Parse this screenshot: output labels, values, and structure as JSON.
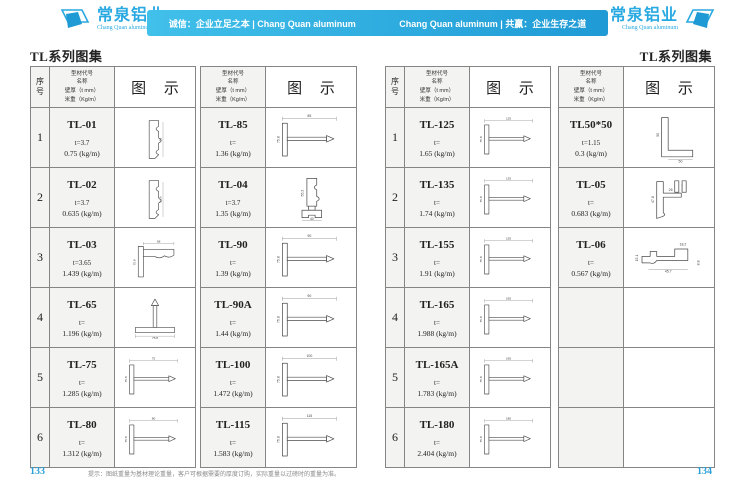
{
  "header": {
    "accent_color": "#29a9e1",
    "logo_left": {
      "name": "常泉铝业",
      "sub": "Chang Quan aluminum"
    },
    "logo_right": {
      "name": "常泉铝业",
      "sub": "Chang Quan aluminum"
    },
    "banner_left": "诚信：企业立足之本 | Chang Quan aluminum",
    "banner_right": "Chang Quan aluminum | 共赢：企业生存之道"
  },
  "page_left": {
    "title": "TL系列图集",
    "page_number": "133",
    "footer_note": "提示：图纸重量为基材理论重量，客户可根据需要的厚度订购，实际重量以过磅时的重量为准。"
  },
  "page_right": {
    "title": "TL系列图集",
    "page_number": "134"
  },
  "table_header": {
    "col_index": [
      "序",
      "号"
    ],
    "col_spec_lines": [
      "型材代号",
      "名称",
      "壁厚（t mm）",
      "米重（Kg/m）"
    ],
    "col_diagram": "图 示"
  },
  "tables": [
    {
      "has_index": true,
      "rows": [
        {
          "index": "1",
          "code": "TL-01",
          "thickness": "t=3.7",
          "weight": "0.75 (kg/m)",
          "shape": "moulding-v",
          "dims": {
            "v": "58"
          }
        },
        {
          "index": "2",
          "code": "TL-02",
          "thickness": "t=3.7",
          "weight": "0.635 (kg/m)",
          "shape": "moulding-v",
          "dims": {
            "v": "54.6"
          }
        },
        {
          "index": "3",
          "code": "TL-03",
          "thickness": "t=3.65",
          "weight": "1.439 (kg/m)",
          "shape": "corner",
          "dims": {
            "h": "68",
            "v": "75.8"
          }
        },
        {
          "index": "4",
          "code": "TL-65",
          "thickness": "t=",
          "weight": "1.196 (kg/m)",
          "shape": "tee-up",
          "dims": {
            "h": "75.8"
          }
        },
        {
          "index": "5",
          "code": "TL-75",
          "thickness": "t=",
          "weight": "1.285 (kg/m)",
          "shape": "tee-right",
          "dims": {
            "h": "75",
            "v": "75.8"
          }
        },
        {
          "index": "6",
          "code": "TL-80",
          "thickness": "t=",
          "weight": "1.312 (kg/m)",
          "shape": "tee-right",
          "dims": {
            "h": "80",
            "v": "75.8"
          }
        }
      ]
    },
    {
      "has_index": false,
      "rows": [
        {
          "code": "TL-85",
          "thickness": "t=",
          "weight": "1.36 (kg/m)",
          "shape": "tee-right",
          "dims": {
            "h": "85",
            "v": "75.8"
          }
        },
        {
          "code": "TL-04",
          "thickness": "t=3.7",
          "weight": "1.35 (kg/m)",
          "shape": "moulding-base",
          "dims": {
            "h": "40",
            "v": "55.2"
          }
        },
        {
          "code": "TL-90",
          "thickness": "t=",
          "weight": "1.39 (kg/m)",
          "shape": "tee-right",
          "dims": {
            "h": "90",
            "v": "75.8"
          }
        },
        {
          "code": "TL-90A",
          "thickness": "t=",
          "weight": "1.44 (kg/m)",
          "shape": "tee-right",
          "dims": {
            "h": "90",
            "v": "75.8"
          }
        },
        {
          "code": "TL-100",
          "thickness": "t=",
          "weight": "1.472 (kg/m)",
          "shape": "tee-right",
          "dims": {
            "h": "100",
            "v": "75.8"
          }
        },
        {
          "code": "TL-115",
          "thickness": "t=",
          "weight": "1.583 (kg/m)",
          "shape": "tee-right",
          "dims": {
            "h": "115",
            "v": "75.8"
          }
        }
      ]
    },
    {
      "has_index": true,
      "rows": [
        {
          "index": "1",
          "code": "TL-125",
          "thickness": "t=",
          "weight": "1.65 (kg/m)",
          "shape": "tee-right",
          "dims": {
            "h": "125",
            "v": "75.8"
          }
        },
        {
          "index": "2",
          "code": "TL-135",
          "thickness": "t=",
          "weight": "1.74 (kg/m)",
          "shape": "tee-right",
          "dims": {
            "h": "135",
            "v": "75.8"
          }
        },
        {
          "index": "3",
          "code": "TL-155",
          "thickness": "t=",
          "weight": "1.91 (kg/m)",
          "shape": "tee-right",
          "dims": {
            "h": "155",
            "v": "75.8"
          }
        },
        {
          "index": "4",
          "code": "TL-165",
          "thickness": "t=",
          "weight": "1.988 (kg/m)",
          "shape": "tee-right",
          "dims": {
            "h": "165",
            "v": "75.8"
          }
        },
        {
          "index": "5",
          "code": "TL-165A",
          "thickness": "t=",
          "weight": "1.783 (kg/m)",
          "shape": "tee-right",
          "dims": {
            "h": "165",
            "v": "75.8"
          }
        },
        {
          "index": "6",
          "code": "TL-180",
          "thickness": "t=",
          "weight": "2.404 (kg/m)",
          "shape": "tee-right",
          "dims": {
            "h": "180",
            "v": "75.8"
          }
        }
      ]
    },
    {
      "has_index": false,
      "rows": [
        {
          "code": "TL50*50",
          "thickness": "t=1.15",
          "weight": "0.3 (kg/m)",
          "shape": "angle",
          "dims": {
            "h": "50",
            "v": "50"
          }
        },
        {
          "code": "TL-05",
          "thickness": "t=",
          "weight": "0.683 (kg/m)",
          "shape": "profile-05",
          "dims": {
            "v": "47.8",
            "h": "26",
            "a": "21",
            "b": "24.5"
          }
        },
        {
          "code": "TL-06",
          "thickness": "t=",
          "weight": "0.567 (kg/m)",
          "shape": "profile-06",
          "dims": {
            "h": "45.7",
            "v": "15.1",
            "a": "18.2",
            "b": "8.8"
          }
        },
        {
          "code": "",
          "thickness": "",
          "weight": "",
          "shape": "empty"
        },
        {
          "code": "",
          "thickness": "",
          "weight": "",
          "shape": "empty"
        },
        {
          "code": "",
          "thickness": "",
          "weight": "",
          "shape": "empty"
        }
      ]
    }
  ]
}
